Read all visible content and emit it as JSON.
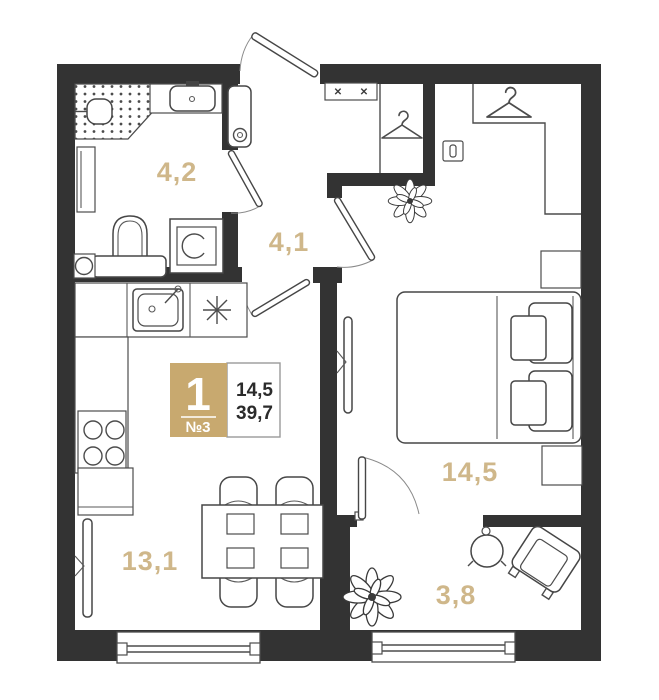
{
  "badge": {
    "rooms_count": "1",
    "apartment_number": "№3",
    "living_area": "14,5",
    "total_area": "39,7"
  },
  "rooms": [
    {
      "name": "bathroom",
      "area": "4,2"
    },
    {
      "name": "hallway",
      "area": "4,1"
    },
    {
      "name": "bedroom",
      "area": "14,5"
    },
    {
      "name": "kitchen-living",
      "area": "13,1"
    },
    {
      "name": "balcony",
      "area": "3,8"
    }
  ],
  "icons": {
    "cross_mark": "✕",
    "hanger": "clothes-hanger",
    "stove": "eight-spoke-star",
    "plant": "potted-plant"
  },
  "colors": {
    "wall": "#333333",
    "accent_tan": "#c8a96f",
    "room_label": "#cfb78a",
    "line": "#4c4c4c"
  }
}
